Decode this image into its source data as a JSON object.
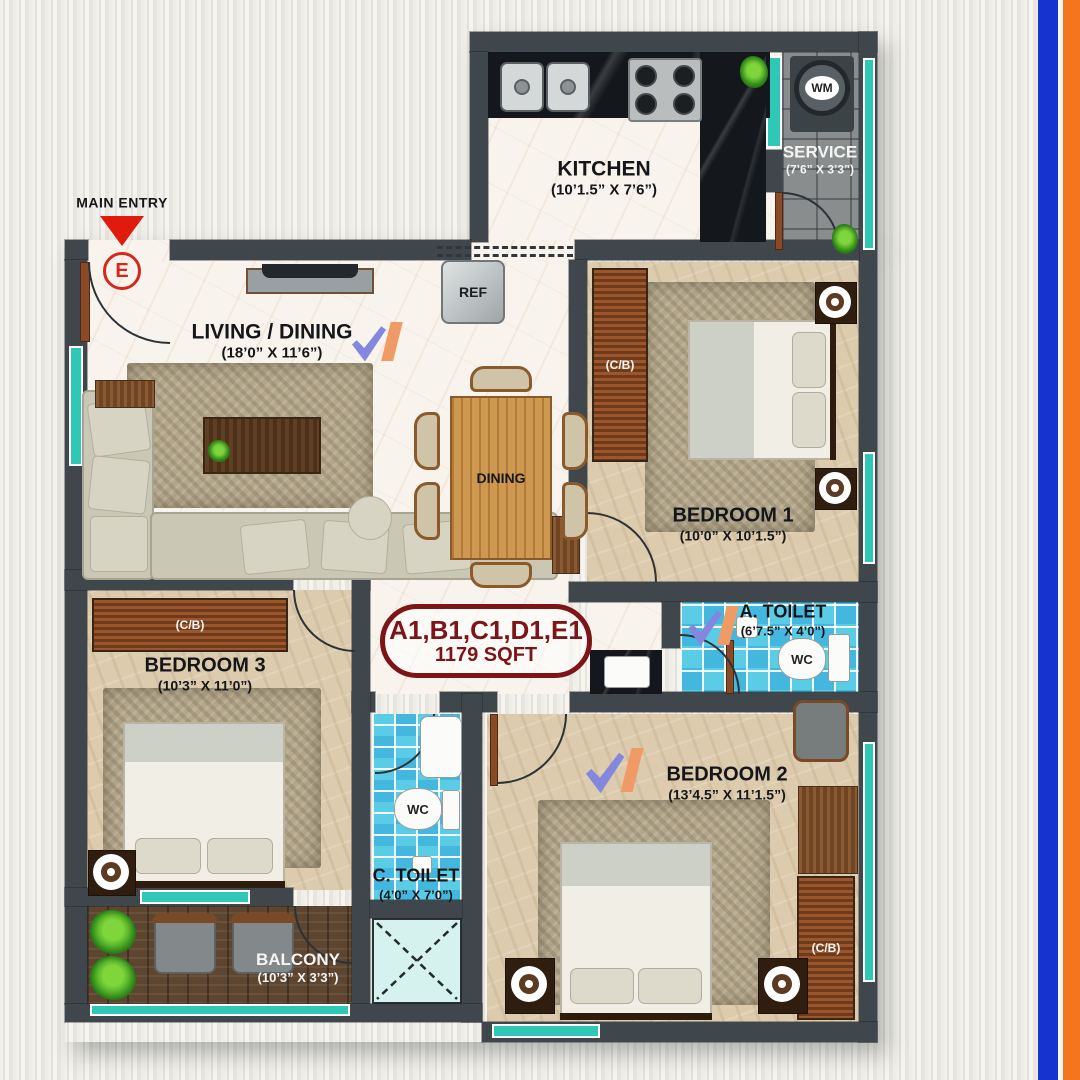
{
  "meta": {
    "title": "Apartment unit floor plan",
    "type": "architectural-floor-plan"
  },
  "palette": {
    "wall": "#3f474c",
    "accent_red": "#d6281a",
    "maroon": "#7d1417",
    "window_teal": "#2fc7b5",
    "tile_blue": "#5acce6",
    "floor_beige": "#dccbad",
    "blue_stripe": "#1733cf",
    "orange_stripe": "#f4751d"
  },
  "entry": {
    "label": "MAIN ENTRY",
    "symbol": "E"
  },
  "unit": {
    "line1": "A1,B1,C1,D1,E1",
    "line2": "1179 SQFT"
  },
  "rooms": {
    "kitchen": {
      "name": "KITCHEN",
      "dims": "(10’1.5” X 7’6”)"
    },
    "service": {
      "name": "SERVICE",
      "dims": "(7’6” X 3’3”)"
    },
    "living": {
      "name": "LIVING / DINING",
      "dims": "(18’0” X 11’6”)"
    },
    "dining": {
      "name": "DINING"
    },
    "bedroom1": {
      "name": "BEDROOM 1",
      "dims": "(10’0” X 10’1.5”)"
    },
    "bedroom2": {
      "name": "BEDROOM 2",
      "dims": "(13’4.5” X 11’1.5”)"
    },
    "bedroom3": {
      "name": "BEDROOM 3",
      "dims": "(10’3” X 11’0”)"
    },
    "a_toilet": {
      "name": "A. TOILET",
      "dims": "(6’7.5” X 4’0”)"
    },
    "c_toilet": {
      "name": "C. TOILET",
      "dims": "(4’0” X 7’0”)"
    },
    "balcony": {
      "name": "BALCONY",
      "dims": "(10’3” X 3’3”)"
    }
  },
  "fixtures": {
    "wm": "WM",
    "ref": "REF",
    "wc": "WC",
    "wardrobe": "(C/B)"
  }
}
